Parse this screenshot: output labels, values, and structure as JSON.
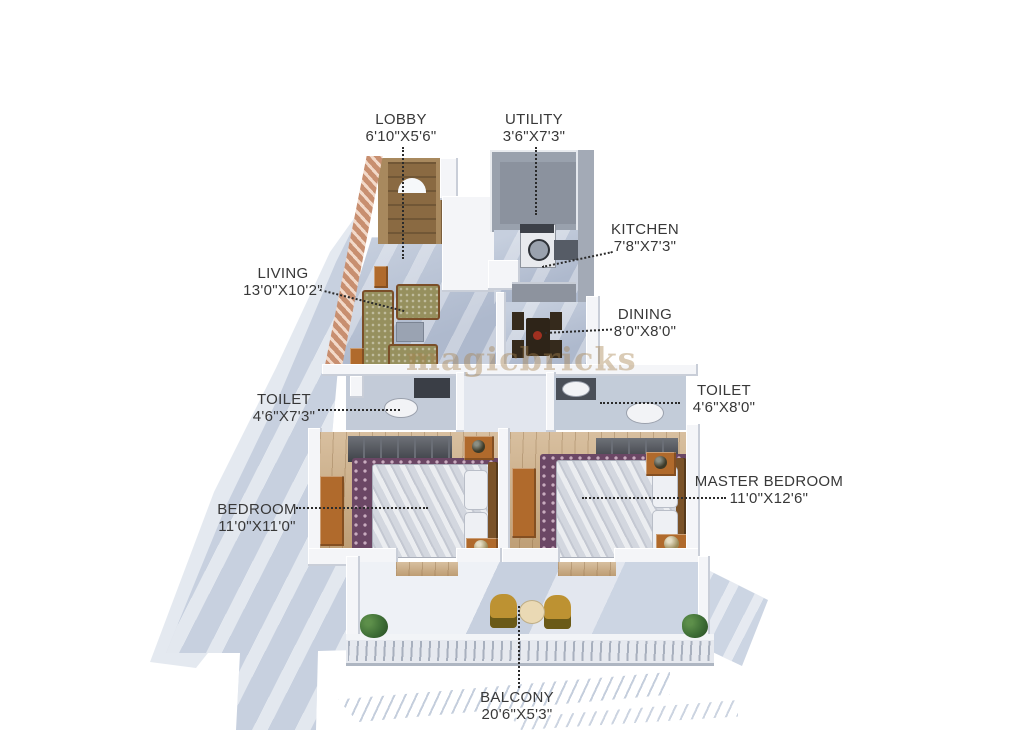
{
  "watermark": "magicbricks",
  "rooms": [
    {
      "id": "lobby",
      "label": "LOBBY",
      "dims": "6'10\"X5'6\""
    },
    {
      "id": "utility",
      "label": "UTILITY",
      "dims": "3'6\"X7'3\""
    },
    {
      "id": "kitchen",
      "label": "KITCHEN",
      "dims": "7'8\"X7'3\""
    },
    {
      "id": "living",
      "label": "LIVING",
      "dims": "13'0\"X10'2\""
    },
    {
      "id": "dining",
      "label": "DINING",
      "dims": "8'0\"X8'0\""
    },
    {
      "id": "toilet_left",
      "label": "TOILET",
      "dims": "4'6\"X7'3\""
    },
    {
      "id": "toilet_right",
      "label": "TOILET",
      "dims": "4'6\"X8'0\""
    },
    {
      "id": "bedroom",
      "label": "BEDROOM",
      "dims": "11'0\"X11'0\""
    },
    {
      "id": "master_bedroom",
      "label": "MASTER BEDROOM",
      "dims": "11'0\"X12'6\""
    },
    {
      "id": "balcony",
      "label": "BALCONY",
      "dims": "20'6\"X5'3\""
    }
  ],
  "palette": {
    "shadow": "#c7d0df",
    "floor_tile": "#b4bfd2",
    "floor_wood": "#c9a77b",
    "wall": "#f4f5f8",
    "door_wood": "#8a6a42",
    "brick_wall": "#c88f70",
    "furniture_orange": "#b06a2c",
    "wardrobe": "#4e525a",
    "rug": "#6b4765",
    "label_text": "#383838"
  }
}
